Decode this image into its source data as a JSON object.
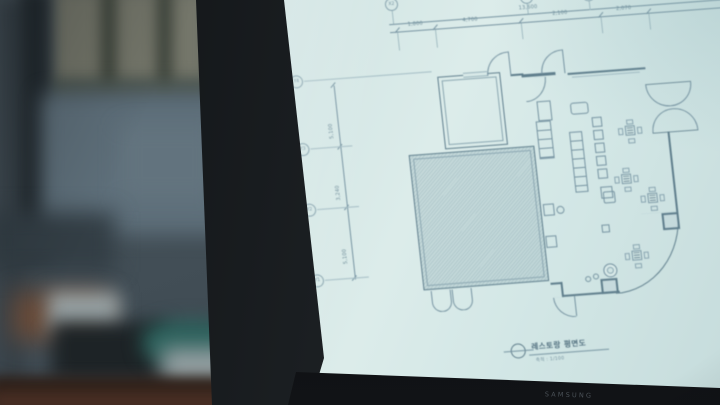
{
  "monitor": {
    "brand": "SAMSUNG"
  },
  "drawing": {
    "title": "레스토랑 평면도",
    "scale_note": "축척 : 1/100",
    "overall_dim": "13,600",
    "top_segments": [
      "1,800",
      "4,700",
      "2,100",
      "2,070"
    ],
    "left_segments": [
      "5,100",
      "3,240",
      "5,100"
    ],
    "grid_top": [
      "X2",
      "X3",
      "X4"
    ],
    "grid_left": [
      "Y4",
      "Y3",
      "Y2",
      "Y1"
    ]
  },
  "colors": {
    "screen_paper": "#d8e9e8",
    "drawing_line": "#7693a1",
    "drawing_wall": "#5f7e8c",
    "bezel": "#15181b",
    "background_wall": "#5e6f7a",
    "desk": "#2e2019",
    "teal_object": "#2c615c"
  }
}
